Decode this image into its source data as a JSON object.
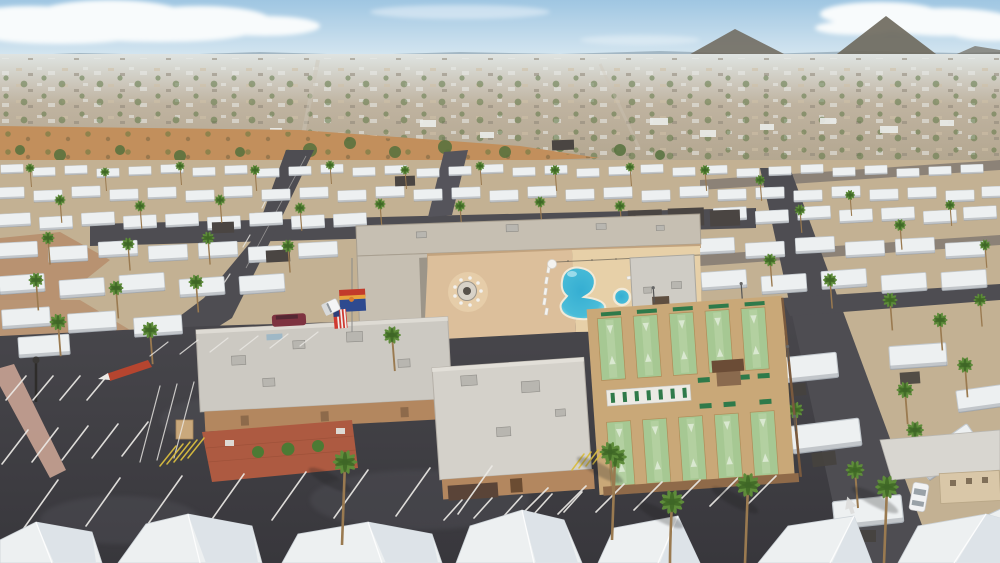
{
  "scene": {
    "type": "aerial-drone-photograph",
    "description": "Midday aerial view of a desert mobile-home resort community: central clubhouse complex with swimming pool, spa, fire-pit courtyard and ten shuffleboard lanes, surrounded by rows of white-roofed mobile homes, palm trees, a large asphalt parking lot, and a hazy city skyline with two mountain peaks on the horizon.",
    "canvas": {
      "width": 1000,
      "height": 563
    },
    "horizon": {
      "mountain_peaks": 2,
      "clouds": "white banks upper-left and upper-right"
    },
    "resort": {
      "pools": 1,
      "spas": 1,
      "shuffleboard_lanes": 10,
      "fire_pit": 1,
      "flags": [
        "arizona-flag",
        "american-flag"
      ],
      "buildings": [
        "north-wing",
        "west-clubhouse",
        "center-hall",
        "pool-house",
        "court-shed"
      ]
    },
    "vehicles": [
      "white-pickup-truck",
      "maroon-minivan",
      "white-sedan"
    ],
    "environment": [
      "mobile-home-rows",
      "palm-trees",
      "desert-strip",
      "parking-lot",
      "streets"
    ]
  },
  "palette": {
    "sky_top": "#9fc6e2",
    "sky_horizon": "#dceaf2",
    "cloud": "#f8fbfc",
    "ridge": "#93a8b6",
    "mountain": "#6f6a5e",
    "city_light": "#e9ebe8",
    "city_tan": "#cfc0a6",
    "city_base": "#bfb3a0",
    "city_tree": "#55713d",
    "desert_sand": "#c28f5c",
    "desert_shrub": "#6d7a42",
    "gravel": "#c3b193",
    "dirt_red": "#ad7450",
    "road": "#4e4d52",
    "street_light": "#55545b",
    "asphalt_top": "#49484d",
    "asphalt_bottom": "#38373c",
    "line_white": "#eceae6",
    "line_yellow": "#d9bd3f",
    "curb_red": "#b5452f",
    "sidewalk_pink": "#c9a393",
    "roof_white": "#edf0f1",
    "roof_edge": "#c3c9ce",
    "roof_facet": "#dde3e8",
    "roof_gray": "#ccc9c2",
    "roof_gray2": "#d4d1ca",
    "wall_tan": "#b3875f",
    "wall_tan_dark": "#8f6a49",
    "fascia_tan": "#c2a37e",
    "paver": "#dcbf9b",
    "paver_light": "#e6cda9",
    "pool_deck": "#e7d0a8",
    "pool_deep": "#35aed2",
    "pool_light": "#a5e4ef",
    "pool_coping": "#f2ead8",
    "court_tan": "#c9a878",
    "court_green": "#a6c893",
    "court_green_light": "#bcd6aa",
    "court_wall": "#7a5a3e",
    "bench_green": "#2f7a4a",
    "brick_red": "#ad5a41",
    "bush_green": "#4c7a34",
    "palm_green": "#5e8c3a",
    "palm_dark": "#3e6626",
    "palm_trunk": "#9a7a50",
    "flag_red": "#c23b2b",
    "flag_yellow": "#e8a33d",
    "flag_blue": "#2e4a8f",
    "flag_star": "#d97c2e",
    "us_red": "#cf3a30",
    "us_blue": "#2e3f7a",
    "truck_white": "#f4f5f6",
    "van_maroon": "#7e3340",
    "sedan_white": "#f2f3f4",
    "shed_brown": "#8a6a4e",
    "shed_roof": "#6b4c36"
  }
}
